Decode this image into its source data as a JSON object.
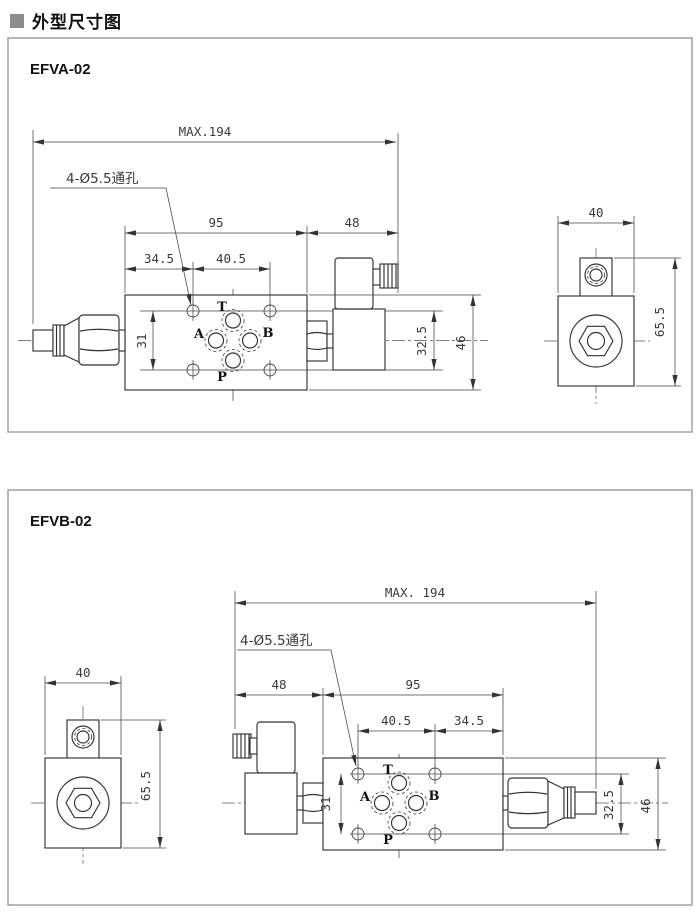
{
  "header": {
    "bullet": "■",
    "title": "外型尺寸图"
  },
  "colors": {
    "line": "#333333",
    "panel_border": "#9a9a9a",
    "dim_text": "#3a3a3a",
    "header_bullet": "#8c8c8c"
  },
  "panels": [
    {
      "model": "EFVA-02",
      "leader_label": "4-Ø5.5通孔",
      "ports": {
        "top": "T",
        "left": "A",
        "right": "B",
        "bottom": "P"
      },
      "dims": {
        "overall": "MAX.194",
        "body_width": "95",
        "solenoid_width": "48",
        "hole_offset": "34.5",
        "hole_pitch": "40.5",
        "hole_pitch_v": "31",
        "coil_height": "32.5",
        "body_height": "46",
        "side_width": "40",
        "side_height": "65.5"
      }
    },
    {
      "model": "EFVB-02",
      "leader_label": "4-Ø5.5通孔",
      "ports": {
        "top": "T",
        "left": "A",
        "right": "B",
        "bottom": "P"
      },
      "dims": {
        "overall": "MAX. 194",
        "solenoid_width": "48",
        "body_width": "95",
        "hole_pitch": "40.5",
        "hole_offset": "34.5",
        "hole_pitch_v": "31",
        "coil_height": "32.5",
        "body_height": "46",
        "side_width": "40",
        "side_height": "65.5"
      }
    }
  ]
}
